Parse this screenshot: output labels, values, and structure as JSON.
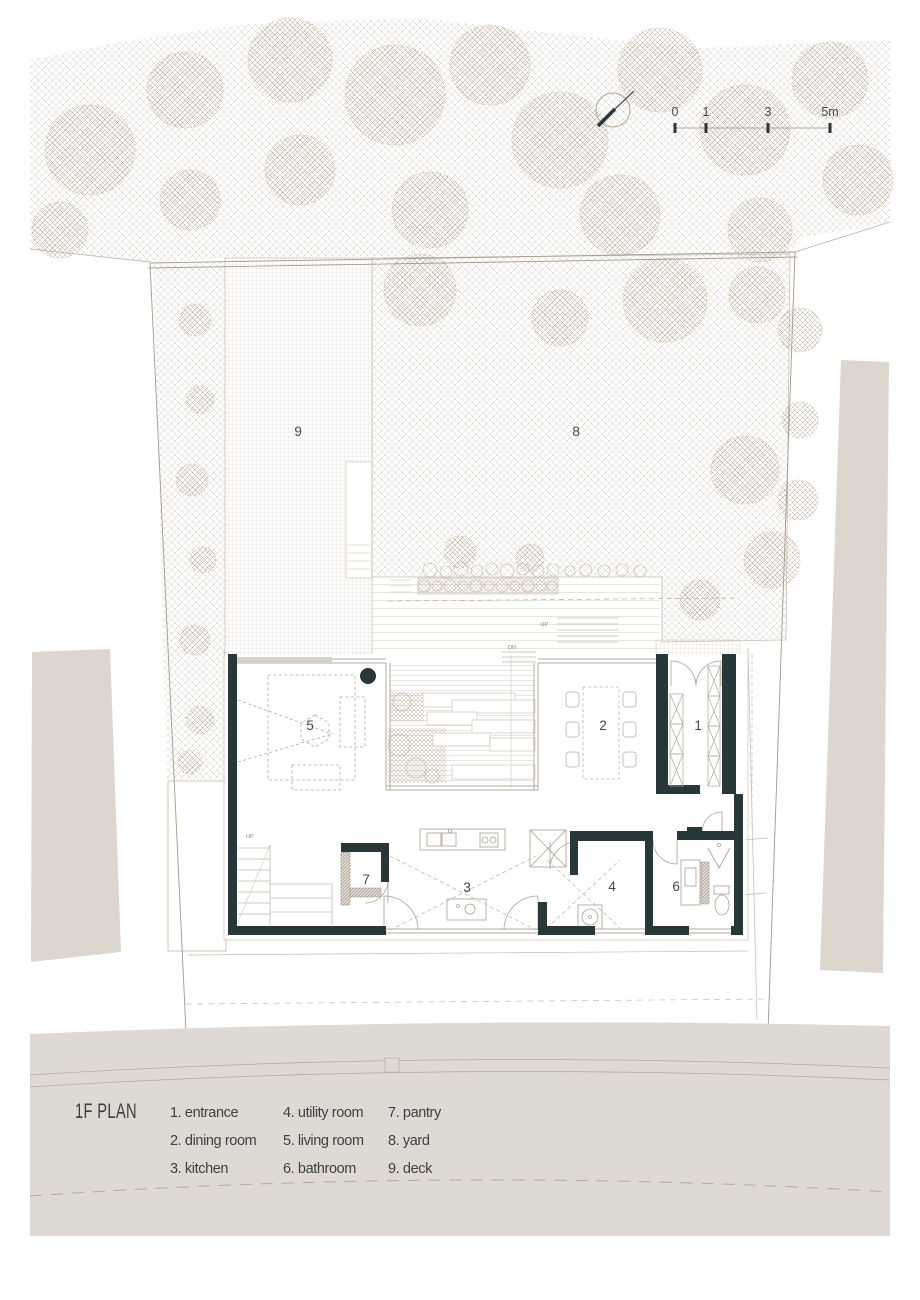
{
  "plan": {
    "title": "1F PLAN",
    "rooms": [
      {
        "num": "1",
        "name": "entrance",
        "display": "1. entrance"
      },
      {
        "num": "2",
        "name": "dining room",
        "display": "2. dining room"
      },
      {
        "num": "3",
        "name": "kitchen",
        "display": "3. kitchen"
      },
      {
        "num": "4",
        "name": "utility room",
        "display": "4. utility room"
      },
      {
        "num": "5",
        "name": "living room",
        "display": "5. living room"
      },
      {
        "num": "6",
        "name": "bathroom",
        "display": "6. bathroom"
      },
      {
        "num": "7",
        "name": "pantry",
        "display": "7. pantry"
      },
      {
        "num": "8",
        "name": "yard",
        "display": "8. yard"
      },
      {
        "num": "9",
        "name": "deck",
        "display": "9. deck"
      }
    ],
    "stair_labels": {
      "up": "UP",
      "dn": "DN"
    }
  },
  "scale_bar": {
    "ticks": [
      "0",
      "1",
      "3",
      "5m"
    ]
  },
  "colors": {
    "wall": "#283839",
    "road_fill": "#ded9d2",
    "neighbor_fill": "#dcd6cf",
    "boundary_line": "#a5998a",
    "text": "#3f3f3f"
  }
}
